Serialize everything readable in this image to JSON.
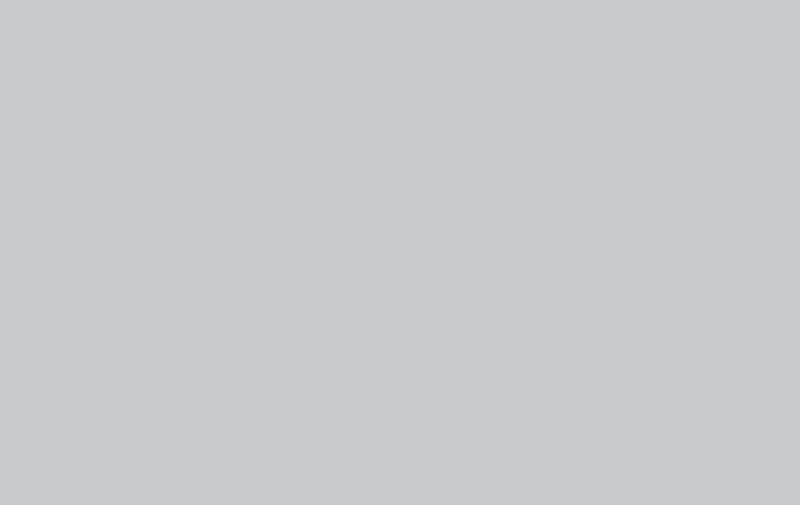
{
  "scene": {
    "title": "3D isometric cutaway rendering of a laboratory floor plan",
    "description": "Architectural 3D render on a gray background: white-walled lab floor containing a main chemistry laboratory with teal island benches, dark worktops, glass reagent shelves and red ceiling-mounted fume extractor arms; an open-plan office with cubicle workstations and mesh chairs; a private office with wooden bookshelf cabinets; two beige staircases with glass balustrades; corridor, storage and utility rooms; glass window panels set into the perimeter walls.",
    "style": "isometric architectural cutaway, no visible text",
    "rooms": [
      {
        "name": "storage-room",
        "position": "far-left",
        "floor": "beige-tile"
      },
      {
        "name": "small-lab",
        "position": "top-left",
        "features": "L-shaped bench with fume extractor arms"
      },
      {
        "name": "left-stairwell",
        "features": "beige staircase, glass balustrade, handrail"
      },
      {
        "name": "utility-room-1",
        "position": "lower-left",
        "floor": "beige-tile"
      },
      {
        "name": "bottom-stairwell",
        "features": "beige staircase with landing, glass balustrade"
      },
      {
        "name": "utility-room-2",
        "position": "bottom",
        "floor": "beige-tile"
      },
      {
        "name": "utility-room-3",
        "position": "bottom",
        "floor": "beige-tile"
      },
      {
        "name": "corridor",
        "features": "white double doors with glass panes"
      },
      {
        "name": "main-laboratory",
        "features": "4 bench rows, reagent shelves, red fume extractor arms, funnel stations"
      },
      {
        "name": "open-plan-office",
        "features": "cubicle partitions, wood desks, monitors, mesh chairs"
      },
      {
        "name": "private-office",
        "features": "wooden bookshelf cabinets, desk, side cabinet"
      }
    ],
    "inventory": {
      "lab_bench_rows": 4,
      "wall_benches": 2,
      "fume_extractor_arms": 18,
      "extraction_funnel_stations": 2,
      "equipment_tables": 1,
      "office_workstations": 10,
      "office_chairs": 10,
      "cubicle_partition_rows": 3,
      "bookshelf_cabinets": 2,
      "side_cabinets": 1,
      "staircases": 2,
      "glass_balustrades": 2,
      "double_doors": 11,
      "window_glass_panels": 11,
      "ac_units": 2
    }
  },
  "palette": {
    "background": "#c7c8c9",
    "backgroundLight": "#d2d3d4",
    "wallTop": "#f3f4f5",
    "wallLight": "#fbfcfc",
    "wallShade": "#e7e9ea",
    "wallOuter": "#f8f9f9",
    "floorBase": "#e9ece5",
    "floorBeige": "#eae2cb",
    "floorBeigeLine": "#d9cfb4",
    "floorLab": "#e7ece7",
    "floorOffice": "#eae7da",
    "corridor": "#eceee7",
    "benchCabinet": "#9edccb",
    "benchCabinetSide": "#7fcdbb",
    "benchTop": "#232c39",
    "benchTopSide": "#151c26",
    "shelfGlass": "#bfe8df",
    "glass": "#b9e4da",
    "glassBright": "#e8f7f3",
    "red": "#c74840",
    "redDark": "#9e322c",
    "redLight": "#d97a72",
    "wood": "#d9bd8a",
    "woodSide": "#c3a167",
    "woodDark": "#b8914f",
    "woodFaceLight": "#f0e3c0",
    "partition": "#c9cdd0",
    "partitionTop": "#dcdfe1",
    "chair": "#4b5156",
    "chairDark": "#34383c",
    "stairTread": "#f1e8cd",
    "stairRiser": "#e3d8b8",
    "stairSide": "#e9dfc4",
    "rail": "#73777b",
    "doorFace": "#f6f7f7",
    "doorFrame": "#d8dadb",
    "monitor": "#2e343a",
    "white": "#f4f5f5"
  }
}
